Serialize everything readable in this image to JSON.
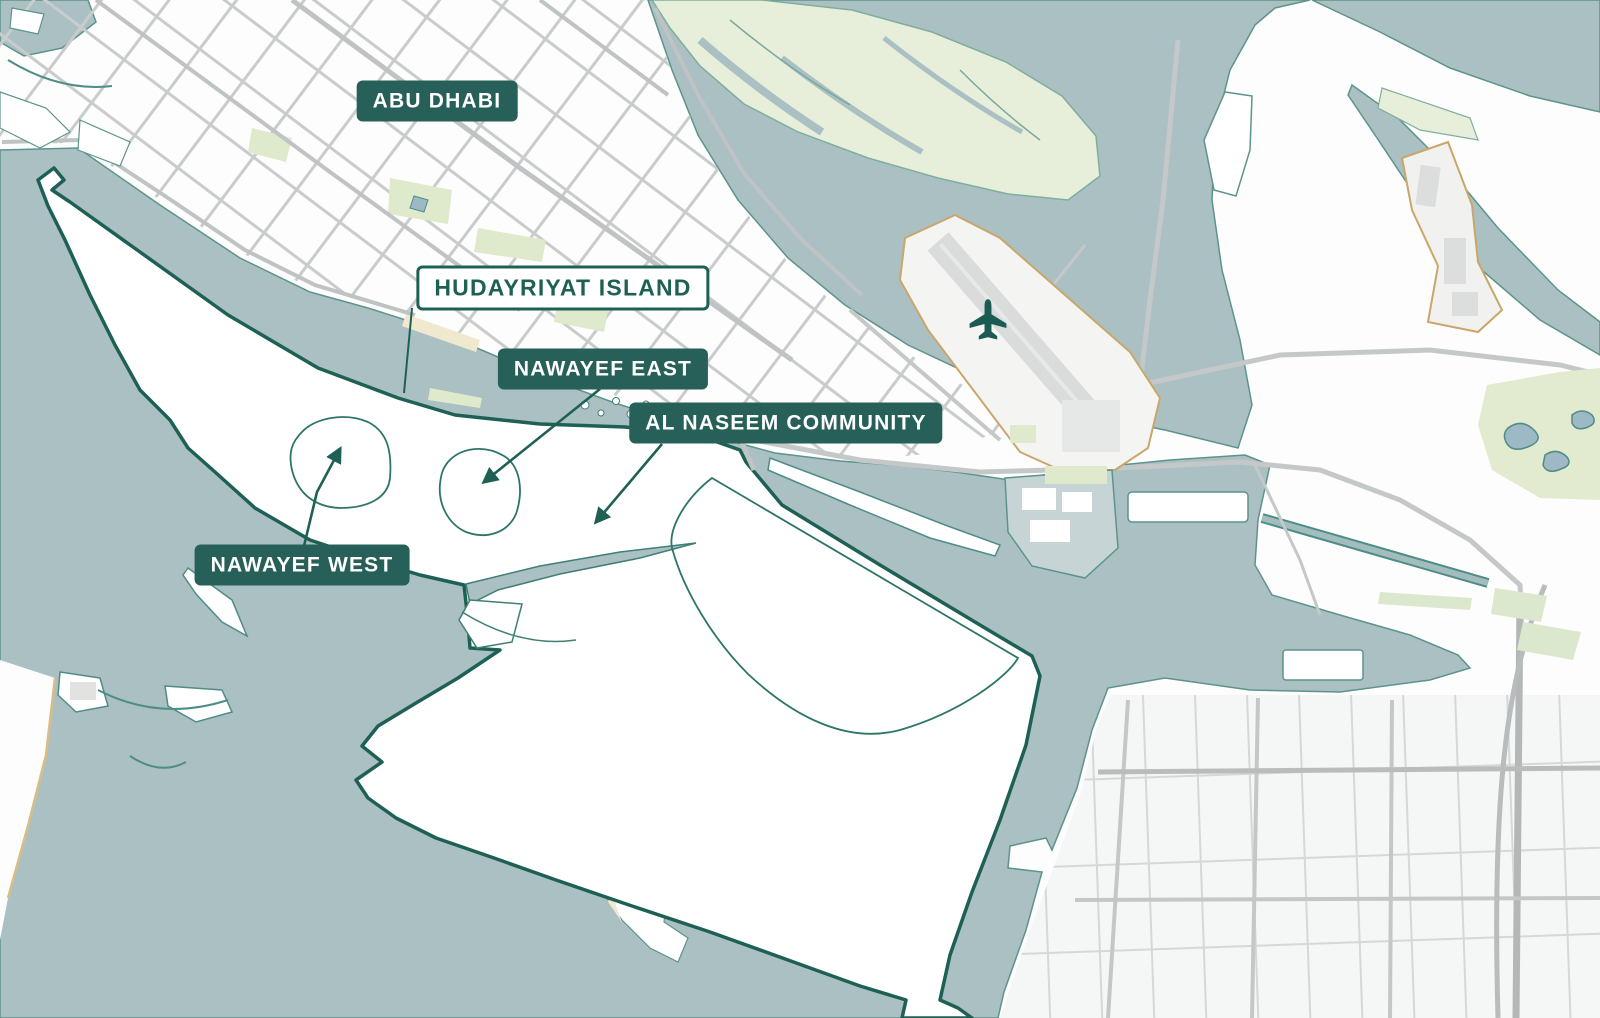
{
  "map": {
    "title": "Abu Dhabi / Hudayriyat Island overview map",
    "labels": {
      "abu_dhabi": "ABU DHABI",
      "hudayriyat_island": "HUDAYRIYAT ISLAND",
      "nawayef_east": "NAWAYEF EAST",
      "al_naseem_community": "AL NASEEM COMMUNITY",
      "nawayef_west": "NAWAYEF WEST"
    },
    "colors": {
      "water": "#abc0c3",
      "land": "#ffffff",
      "island_outline": "#1e6054",
      "label_badge_background": "#266058",
      "label_badge_text": "#ffffff",
      "outlined_label_text": "#1e6054",
      "road_minor": "#c9cccc",
      "road_major": "#b8bcbc",
      "greenery": "#e7eeda",
      "airport_boundary": "#c9a66a",
      "beach_sand": "#f1e9cf"
    },
    "icons": {
      "airport": "airplane-icon"
    }
  }
}
